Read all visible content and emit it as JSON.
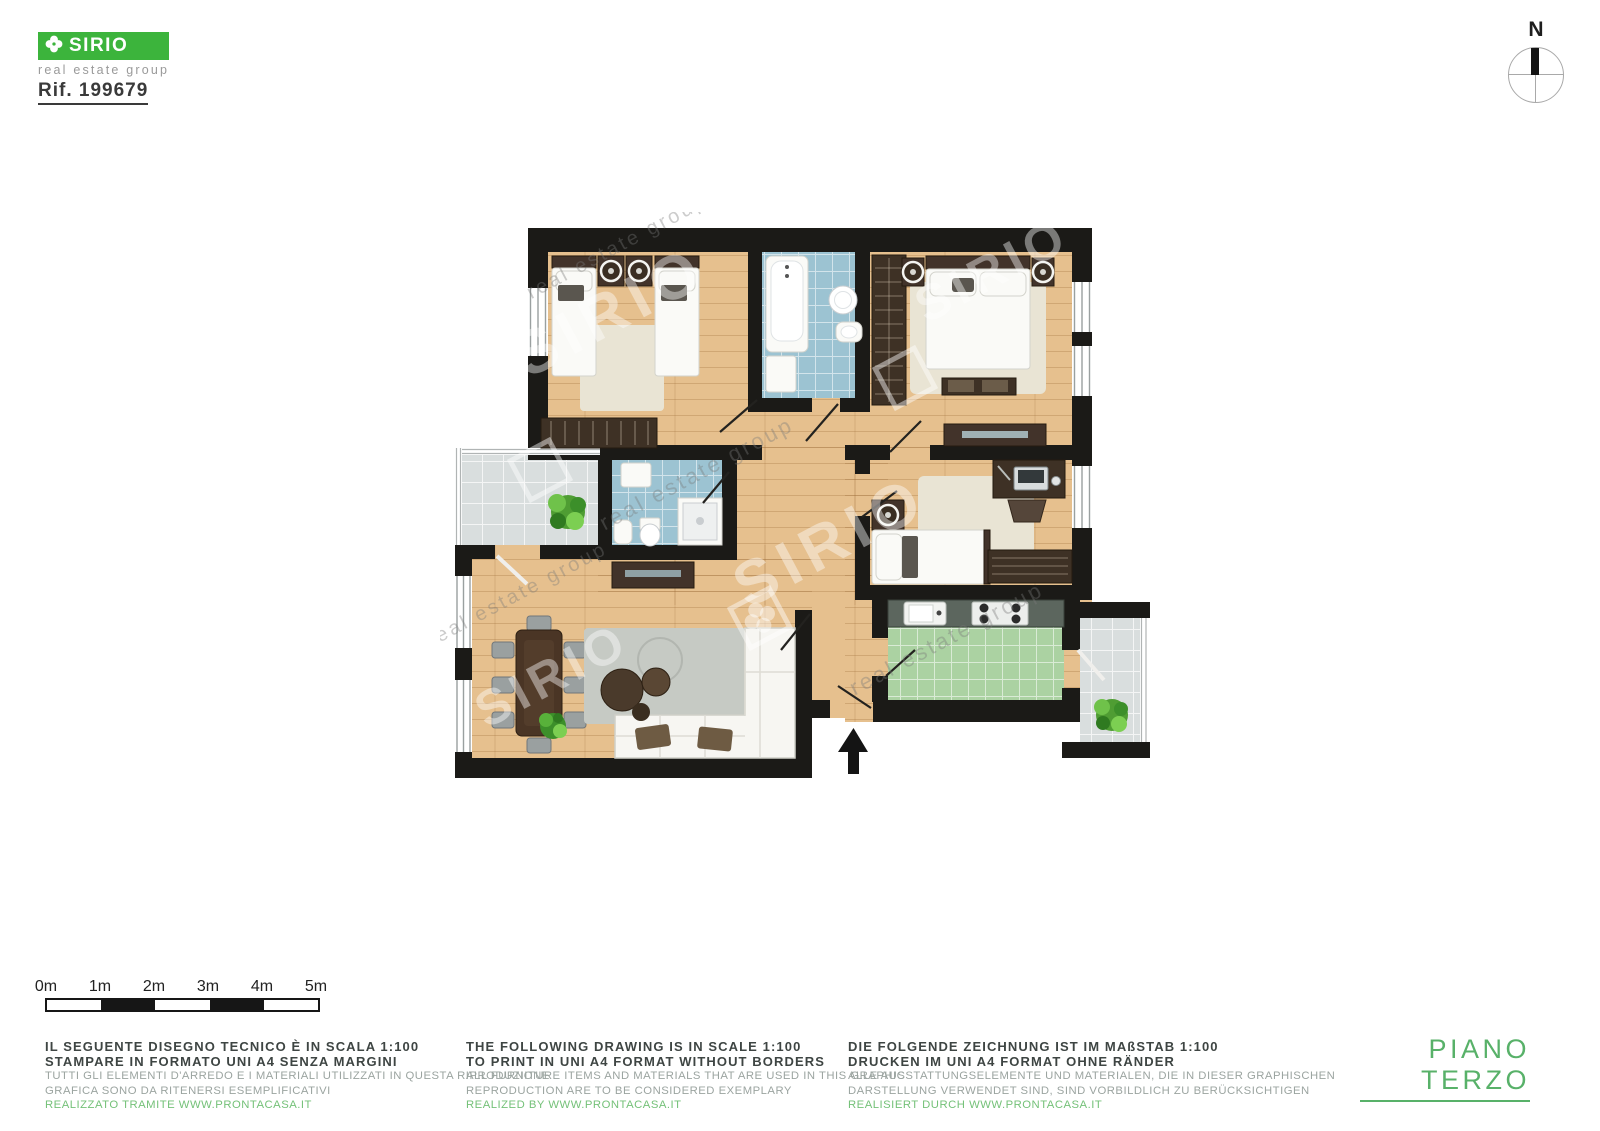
{
  "branding": {
    "logo_text": "SIRIO",
    "tagline": "real estate group",
    "reference": "Rif. 199679"
  },
  "compass": {
    "label": "N"
  },
  "scale_bar": {
    "labels": [
      "0m",
      "1m",
      "2m",
      "3m",
      "4m",
      "5m"
    ]
  },
  "floor_label": "PIANO TERZO",
  "watermark": {
    "name": "SIRIO",
    "tagline": "real estate group"
  },
  "disclaimers": {
    "it": {
      "lines": [
        "IL SEGUENTE DISEGNO TECNICO È IN SCALA 1:100",
        "STAMPARE IN FORMATO UNI A4 SENZA MARGINI",
        "TUTTI GLI ELEMENTI D'ARREDO E I MATERIALI UTILIZZATI IN QUESTA RIPRODUZIONE",
        "GRAFICA SONO DA RITENERSI ESEMPLIFICATIVI",
        "REALIZZATO TRAMITE WWW.PRONTACASA.IT"
      ]
    },
    "en": {
      "lines": [
        "THE FOLLOWING DRAWING IS IN SCALE 1:100",
        "TO PRINT IN UNI A4 FORMAT WITHOUT BORDERS",
        "ALL FURNITURE ITEMS AND MATERIALS THAT ARE USED IN THIS GRAPHIC",
        "REPRODUCTION ARE TO BE CONSIDERED EXEMPLARY",
        "REALIZED BY WWW.PRONTACASA.IT"
      ]
    },
    "de": {
      "lines": [
        "DIE FOLGENDE ZEICHNUNG IST IM MAßSTAB 1:100",
        "DRUCKEN IM UNI A4 FORMAT OHNE RÄNDER",
        "ALLE AUSSTATTUNGSELEMENTE UND MATERIALEN, DIE IN DIESER GRAPHISCHEN",
        "DARSTELLUNG VERWENDET SIND, SIND VORBILDLICH ZU BERÜCKSICHTIGEN",
        "REALISIERT DURCH WWW.PRONTACASA.IT"
      ]
    }
  },
  "colors": {
    "brand_green": "#3cb43c",
    "accent_green": "#58b169",
    "link_green": "#74c178",
    "wall": "#1b1a17",
    "wood": "#e6c08e",
    "tile_blue": "#9cc3d2",
    "tile_green": "#abd2a2",
    "tile_gray": "#d9dede",
    "text_dark": "#3e4543",
    "text_muted": "#9ba4a0"
  }
}
